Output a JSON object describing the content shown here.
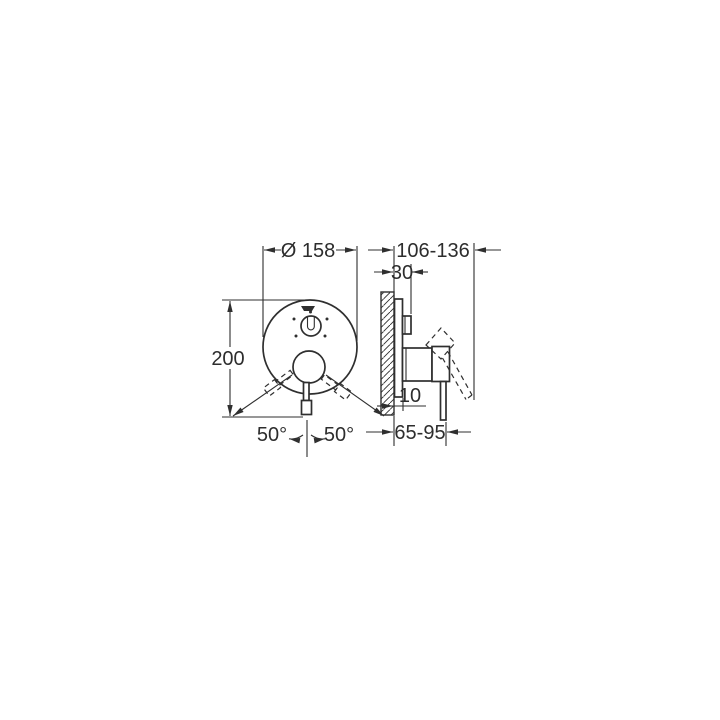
{
  "diagram": {
    "background_color": "#ffffff",
    "line_color": "#2f2f2f",
    "front_view": {
      "diameter": "Ø 158",
      "height": "200",
      "swing_angle_left": "50°",
      "swing_angle_right": "50°"
    },
    "side_view": {
      "wall_to_lever_tip_range": "106-136",
      "knob_projection": "30",
      "wall_to_plate_front": "10",
      "wall_to_lever_range": "65-95"
    }
  }
}
